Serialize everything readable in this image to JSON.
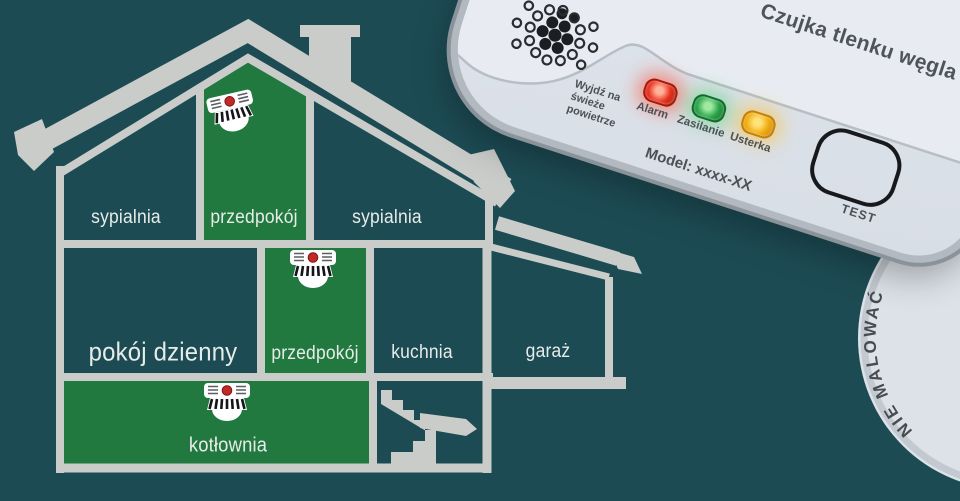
{
  "colors": {
    "background": "#1d4b54",
    "wall_gray": "#c9ccc9",
    "room_highlight_green": "#21793f",
    "device_face": "#dce1e8",
    "label_text": "#e7ece9",
    "device_text": "#4c5156"
  },
  "house": {
    "rooms": [
      {
        "id": "sypialnia-left",
        "label": "sypialnia",
        "highlighted": false,
        "detector": false
      },
      {
        "id": "przedpokoj-attic",
        "label": "przedpokój",
        "highlighted": true,
        "detector": true
      },
      {
        "id": "sypialnia-right",
        "label": "sypialnia",
        "highlighted": false,
        "detector": false
      },
      {
        "id": "pokoj-dzienny",
        "label": "pokój dzienny",
        "highlighted": false,
        "detector": false
      },
      {
        "id": "przedpokoj-mid",
        "label": "przedpokój",
        "highlighted": true,
        "detector": true
      },
      {
        "id": "kuchnia",
        "label": "kuchnia",
        "highlighted": false,
        "detector": false
      },
      {
        "id": "garaz",
        "label": "garaż",
        "highlighted": false,
        "detector": false
      },
      {
        "id": "kotlownia",
        "label": "kotłownia",
        "highlighted": true,
        "detector": true
      }
    ]
  },
  "device": {
    "title": "Czujka tlenku węgla",
    "warning": "Wyjdź na\nświeże\npowietrze",
    "model": "Model: xxxx-XX",
    "test_label": "TEST",
    "leds": [
      {
        "label": "Alarm",
        "state": "on",
        "color": {
          "bright": "#ffb199",
          "base": "#e8321f",
          "dark": "#a81708",
          "glow": "rgba(255,70,40,0.55)"
        }
      },
      {
        "label": "Zasilanie",
        "state": "on",
        "color": {
          "bright": "#9fe8a0",
          "base": "#2aa34a",
          "dark": "#0e6d28",
          "glow": "rgba(80,210,110,0.5)"
        }
      },
      {
        "label": "Usterka",
        "state": "on",
        "color": {
          "bright": "#ffe27a",
          "base": "#f0ad10",
          "dark": "#c77f06",
          "glow": "rgba(255,190,40,0.55)"
        }
      }
    ]
  },
  "mounting_plate": {
    "label": "NIE MALOWAĆ"
  }
}
